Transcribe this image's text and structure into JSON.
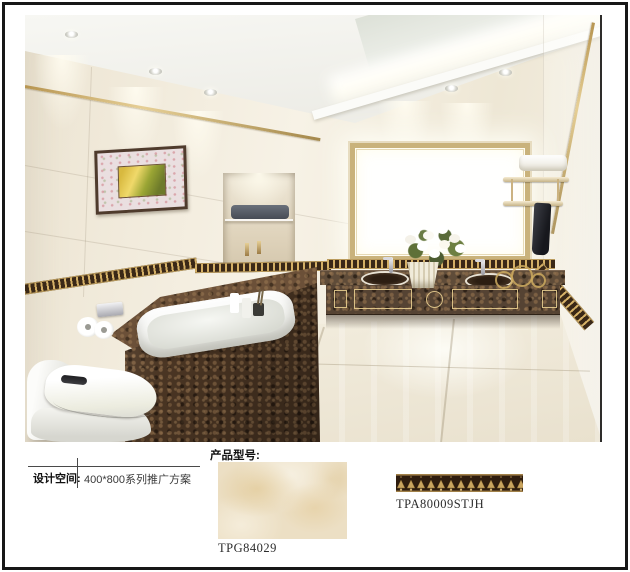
{
  "page": {
    "frame_color": "#171717",
    "background": "#ffffff"
  },
  "scene": {
    "name": "bathroom-rendering",
    "colors": {
      "wall_cream": "#f1ead9",
      "ceiling_white": "#f4f3ee",
      "trim_gold": "#c2a360",
      "waist_strip_brown": "#3a2817",
      "waist_strip_gold": "#c9a45f",
      "marble_dark_emperador": "#46311f",
      "sanitary_white": "#f8f8f4",
      "floor_cream": "#ece5d3",
      "towel_black": "#26272d",
      "leaf_green": "#66753d"
    }
  },
  "info_panel": {
    "design_space": {
      "label": "设计空间:",
      "value": "400*800系列推广方案"
    },
    "product_model_label": "产品型号:",
    "products": [
      {
        "code": "TPG84029"
      },
      {
        "code": "TPA80009STJH"
      }
    ]
  }
}
